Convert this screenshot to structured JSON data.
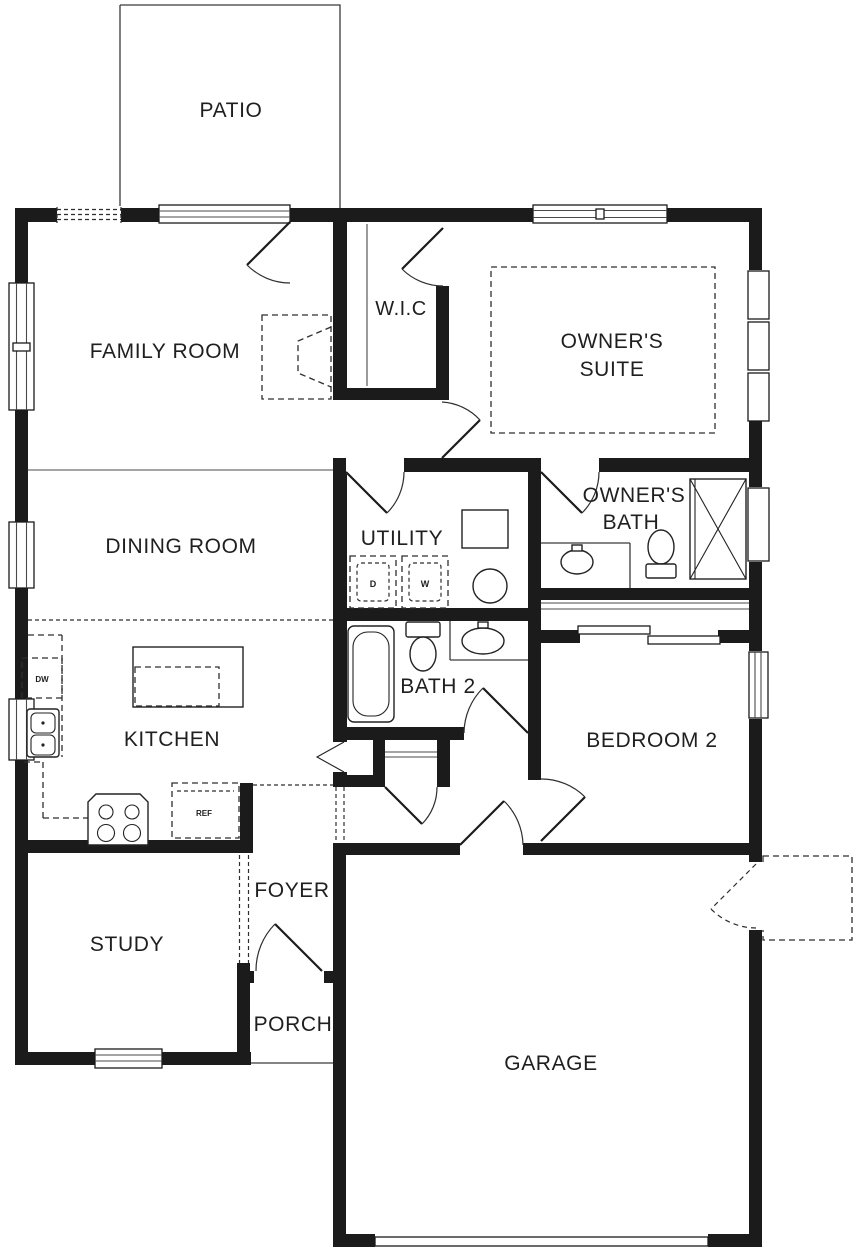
{
  "colors": {
    "wall": "#1b1b1b",
    "line": "#3a3a3a",
    "background": "#ffffff",
    "text": "#1f1f1f"
  },
  "labels": {
    "patio": "PATIO",
    "family_room": "FAMILY ROOM",
    "wic": "W.I.C",
    "owners_suite_line1": "OWNER'S",
    "owners_suite_line2": "SUITE",
    "dining_room": "DINING ROOM",
    "utility": "UTILITY",
    "owners_bath_line1": "OWNER'S",
    "owners_bath_line2": "BATH",
    "bath2": "BATH 2",
    "kitchen": "KITCHEN",
    "bedroom2": "BEDROOM 2",
    "study": "STUDY",
    "foyer": "FOYER",
    "porch": "PORCH",
    "garage": "GARAGE"
  },
  "appliances": {
    "dryer": "D",
    "washer": "W",
    "dishwasher": "DW",
    "refrigerator": "REF"
  }
}
